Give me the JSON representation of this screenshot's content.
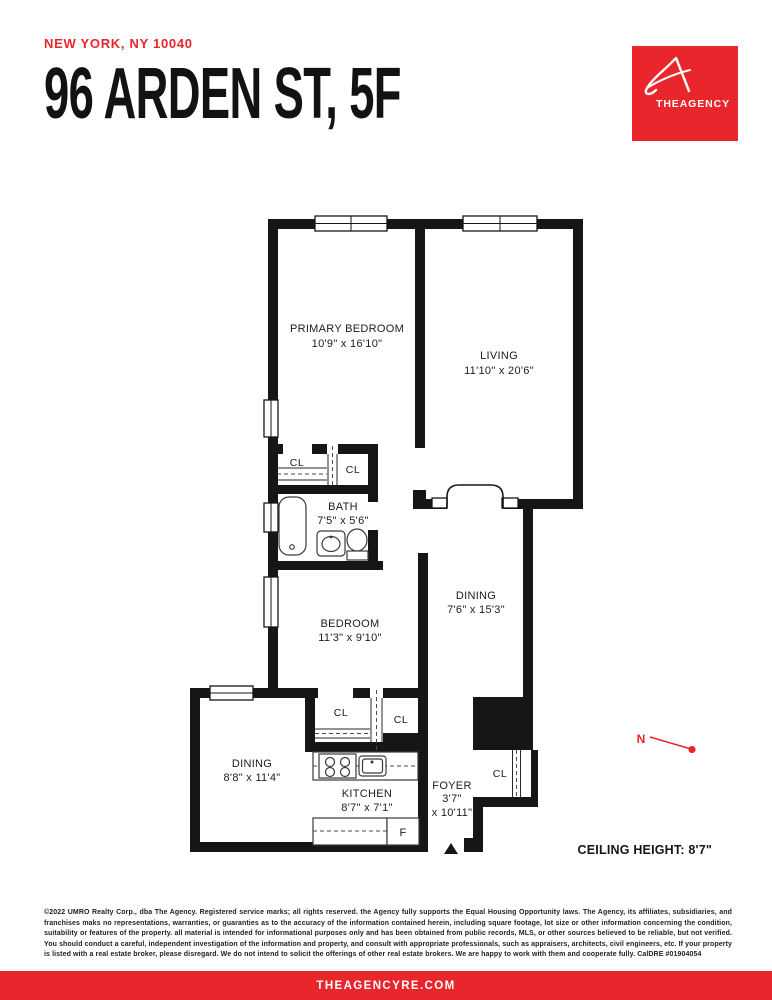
{
  "header": {
    "location": "NEW YORK, NY 10040",
    "title": "96 ARDEN ST, 5F"
  },
  "logo": {
    "brand": "THEAGENCY"
  },
  "floorplan": {
    "rooms": [
      {
        "name": "PRIMARY BEDROOM",
        "dims": "10'9\" x 16'10\""
      },
      {
        "name": "LIVING",
        "dims": "11'10\" x 20'6\""
      },
      {
        "name": "BATH",
        "dims": "7'5\" x 5'6\""
      },
      {
        "name": "DINING",
        "dims": "7'6\" x 15'3\""
      },
      {
        "name": "BEDROOM",
        "dims": "11'3\" x 9'10\""
      },
      {
        "name": "DINING",
        "dims": "8'8\" x 11'4\""
      },
      {
        "name": "KITCHEN",
        "dims": "8'7\" x 7'1\""
      },
      {
        "name": "FOYER",
        "dims_line1": "3'7\"",
        "dims_line2": "x 10'11\""
      }
    ],
    "closet_label": "CL",
    "fridge_label": "F",
    "north_label": "N",
    "ceiling_note": "CEILING HEIGHT: 8'7\""
  },
  "disclaimer": "©2022 UMRO Realty Corp., dba The Agency. Registered service marks; all rights reserved. the Agency fully supports the Equal Housing Opportunity laws. The Agency, its affiliates, subsidiaries, and franchises maks no representations, warranties, or guaranties as to the accuracy of the information contained herein, including square footage, lot size or other information concerning the condition, suitability or features of the property. all material is intended for informational purposes only and has been obtained from public records, MLS, or other sources believed to be reliable, but not verified. You should conduct a careful, independent investigation of the information and property, and consult with appropriate professionals, such as appraisers, architects, civil engineers, etc. If your property is listed with a real estate broker, please disregard. We do not intend to solicit the offerings of other real estate brokers. We are happy to work with them and cooperate fully. CalDRE #01904054",
  "footer": {
    "website": "THEAGENCYRE.COM"
  },
  "colors": {
    "accent_red": "#e8262c",
    "wall_black": "#161616"
  }
}
